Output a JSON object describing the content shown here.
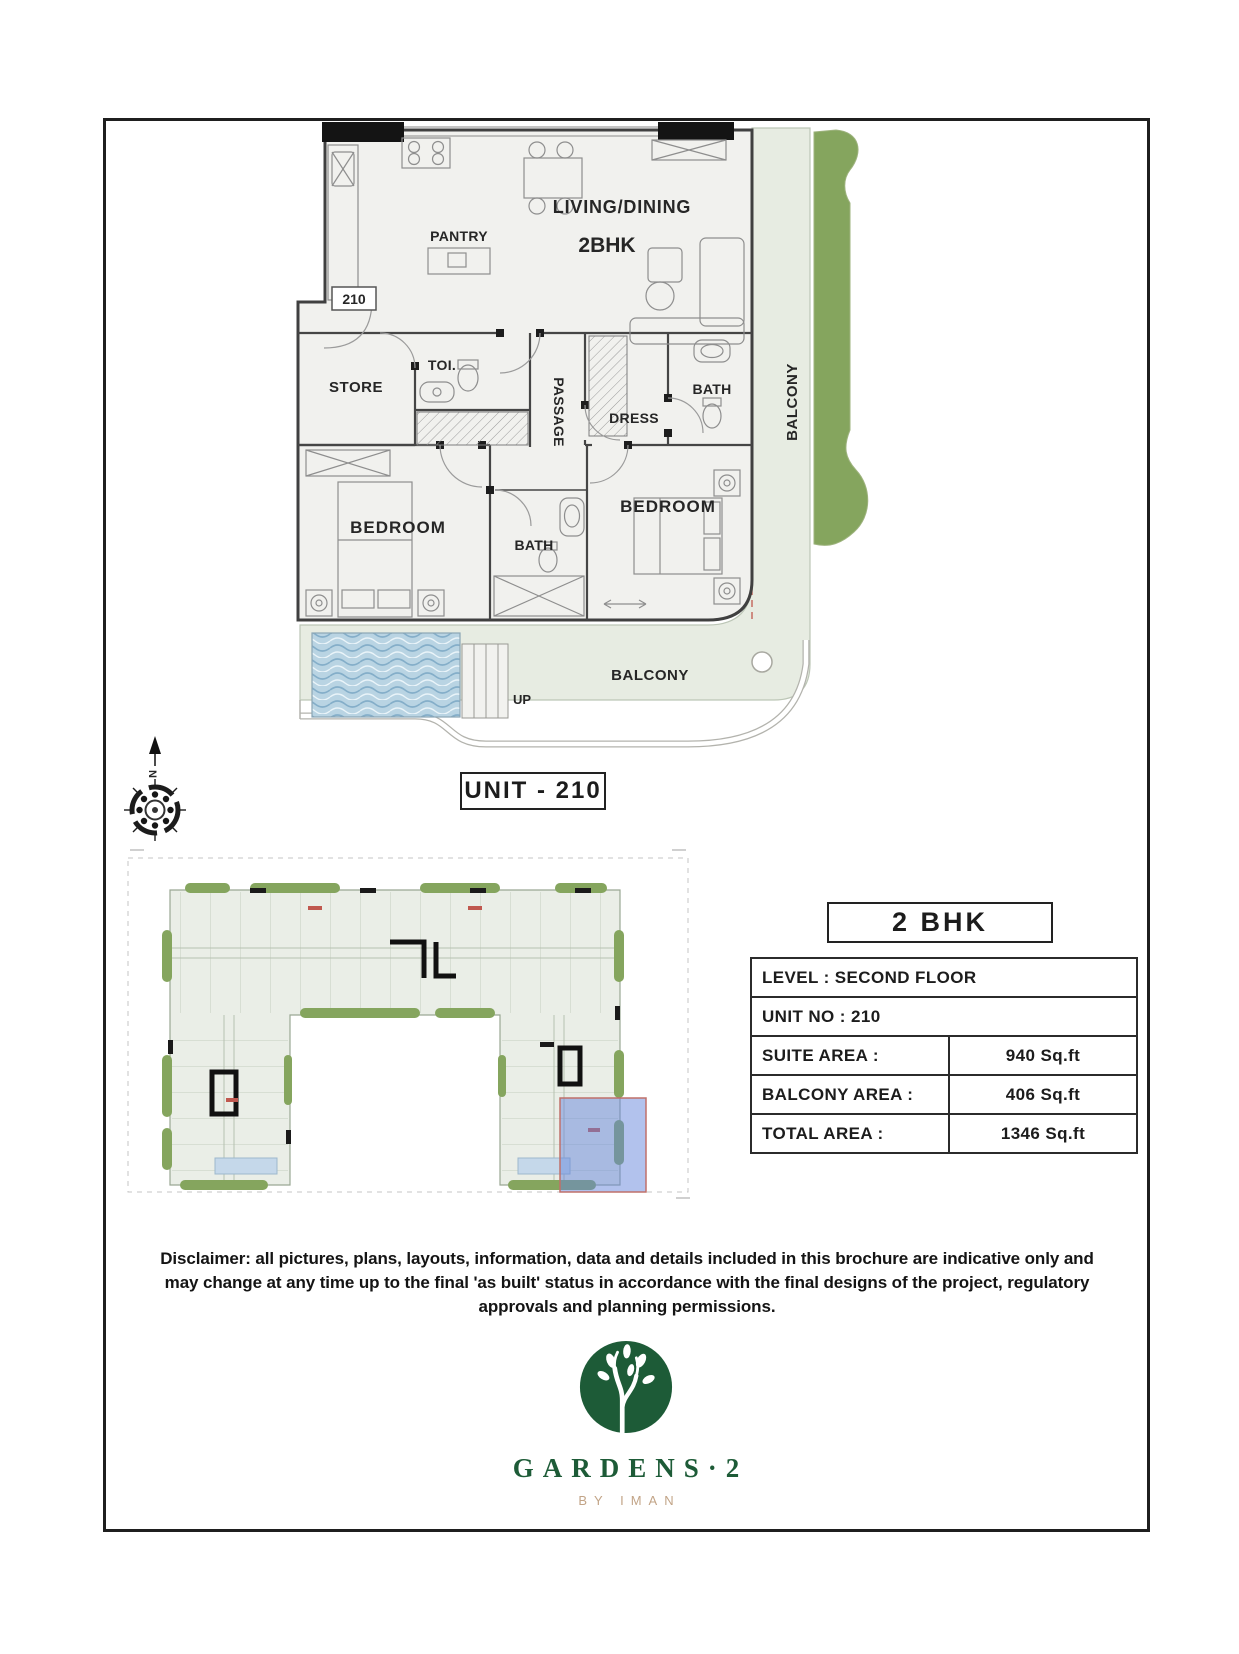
{
  "plan": {
    "living_dining": "LIVING/DINING",
    "unit_type": "2BHK",
    "pantry": "PANTRY",
    "unit_number": "210",
    "store": "STORE",
    "toilet": "TOI.",
    "passage": "PASSAGE",
    "dress": "DRESS",
    "bath": "BATH",
    "bedroom": "BEDROOM",
    "balcony": "BALCONY",
    "up": "UP",
    "north": "N"
  },
  "unit_label": "UNIT - 210",
  "details": {
    "title": "2 BHK",
    "level_row": "LEVEL : SECOND FLOOR",
    "unit_row": "UNIT NO : 210",
    "rows": [
      {
        "label": "SUITE AREA :",
        "value": "940 Sq.ft"
      },
      {
        "label": "BALCONY AREA :",
        "value": "406 Sq.ft"
      },
      {
        "label": "TOTAL AREA :",
        "value": "1346 Sq.ft"
      }
    ]
  },
  "disclaimer": "Disclaimer: all pictures, plans, layouts, information, data and details included in this brochure are indicative only and may change at any time up to the final 'as built' status in accordance with the final designs of the project, regulatory approvals and planning permissions.",
  "brand": {
    "name": "GARDENS·2",
    "byline": "BY IMAN"
  },
  "colors": {
    "brand_green": "#1d5b37",
    "brand_gold": "#c2a487",
    "accent_purple": "#7a2fd6",
    "grass": "#85a55e",
    "pool": "#b9d4e3",
    "highlight_blue": "rgba(102,134,219,0.5)",
    "boundary_red": "#c0584f"
  }
}
